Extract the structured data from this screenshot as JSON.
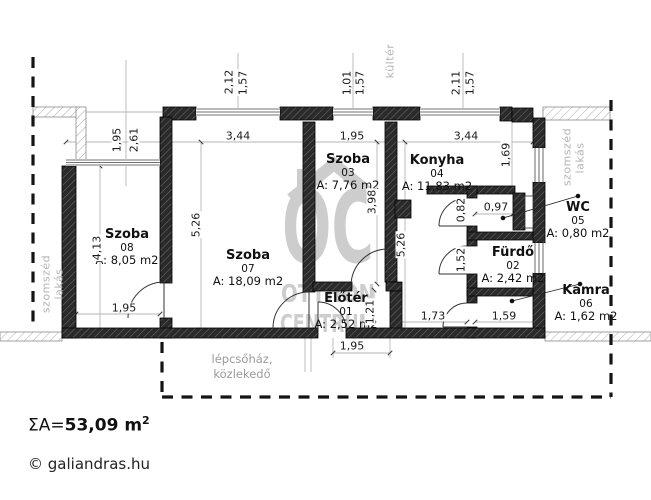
{
  "plan": {
    "rooms": {
      "szoba08": {
        "name": "Szoba",
        "number": "08",
        "area": "A: 8,05 m2"
      },
      "szoba07": {
        "name": "Szoba",
        "number": "07",
        "area": "A: 18,09 m2"
      },
      "szoba03": {
        "name": "Szoba",
        "number": "03",
        "area": "A: 7,76 m2"
      },
      "konyha04": {
        "name": "Konyha",
        "number": "04",
        "area": "A: 11,83 m2"
      },
      "eloter01": {
        "name": "Előtér",
        "number": "01",
        "area": "A: 2,52 m2"
      },
      "furdo02": {
        "name": "Fürdő",
        "number": "02",
        "area": "A: 2,42 m2"
      },
      "wc05": {
        "name": "WC",
        "number": "05",
        "area": "A: 0,80 m2"
      },
      "kamra06": {
        "name": "Kamra",
        "number": "06",
        "area": "A: 1,62 m2"
      }
    },
    "dims": {
      "top1a": "2,12",
      "top1b": "1,57",
      "top2a": "1,01",
      "top2b": "1,57",
      "top3a": "2,11",
      "top3b": "1,57",
      "recess_w": "1,95",
      "recess_h": "2,61",
      "szoba08_h": "4,13",
      "szoba08_w": "1,95",
      "szoba07_h": "5,26",
      "szoba07_w": "3,44",
      "szoba03_w": "1,95",
      "szoba03_h": "3,98",
      "right_h": "5,26",
      "konyha_w": "3,44",
      "konyha_h": "1,69",
      "wc_w": "0,97",
      "wc_h": "0,82",
      "furdo_h": "1,52",
      "eloter_h": "1,21",
      "corridor_w": "1,73",
      "furdo_w": "1,59",
      "eloter_w": "1,95"
    },
    "context": {
      "kulter": "kültér",
      "neighbor_left_1": "szomszéd",
      "neighbor_left_2": "lakás",
      "neighbor_right_1": "szomszéd",
      "neighbor_right_2": "lakás",
      "stairwell_1": "lépcsőház,",
      "stairwell_2": "közlekedő"
    },
    "watermark": {
      "initials": "OC",
      "line1": "OTTHON",
      "line2": "CENTRUM"
    }
  },
  "footer": {
    "sigma_prefix": "ΣA=",
    "total": "53,09 m",
    "sup": "2",
    "credit": "© galiandras.hu"
  },
  "colors": {
    "wall": "#2a2a2a",
    "dim_line": "#b5b5b5",
    "gray_text": "#b4b4b4",
    "watermark": "#cdcdcd"
  }
}
